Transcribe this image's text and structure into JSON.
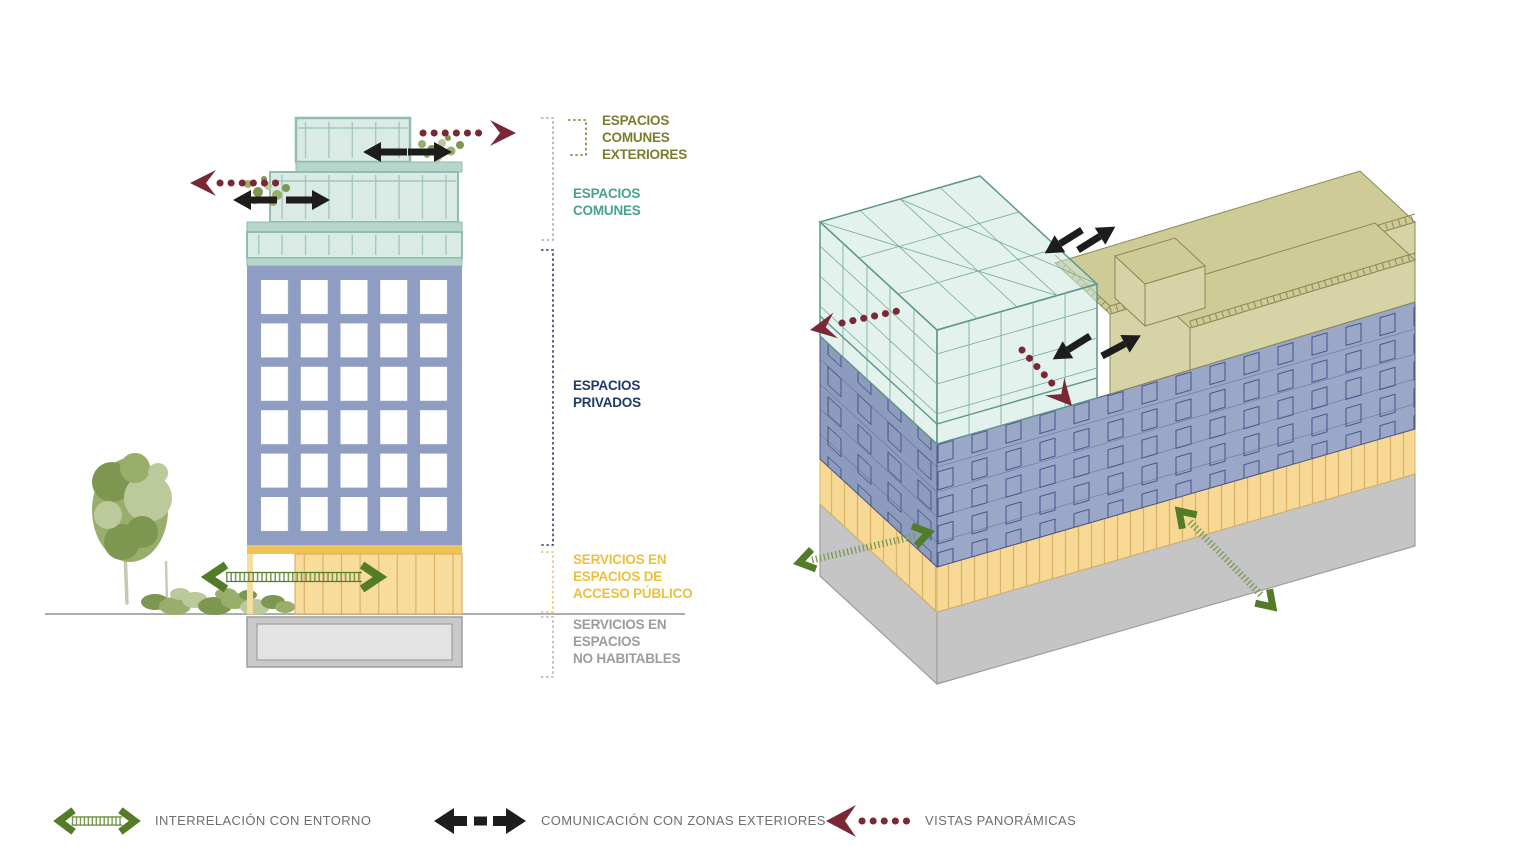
{
  "section_labels": [
    {
      "id": "comunes-exteriores",
      "lines": [
        "ESPACIOS",
        "COMUNES",
        "EXTERIORES"
      ],
      "color": "#7c7c30"
    },
    {
      "id": "comunes",
      "lines": [
        "ESPACIOS",
        "COMUNES"
      ],
      "color": "#47a28f"
    },
    {
      "id": "privados",
      "lines": [
        "ESPACIOS",
        "PRIVADOS"
      ],
      "color": "#1e3a66"
    },
    {
      "id": "servicios-publico",
      "lines": [
        "SERVICIOS EN",
        "ESPACIOS DE",
        "ACCESO PÚBLICO"
      ],
      "color": "#ecbf3e"
    },
    {
      "id": "servicios-no-habitables",
      "lines": [
        "SERVICIOS EN",
        "ESPACIOS",
        "NO HABITABLES"
      ],
      "color": "#9c9c9b"
    }
  ],
  "legend": {
    "items": [
      {
        "icon": "interrelation-arrow-icon",
        "label": "INTERRELACIÓN CON ENTORNO"
      },
      {
        "icon": "communication-arrow-icon",
        "label": "COMUNICACIÓN CON ZONAS EXTERIORES"
      },
      {
        "icon": "panoramic-views-arrow-icon",
        "label": "VISTAS PANORÁMICAS"
      }
    ]
  },
  "colors": {
    "teal_glass": "#d9ebe4",
    "teal_slab": "#b7d5cc",
    "teal_frame": "#8fbdb1",
    "teal_mullion": "#a3c7bd",
    "teal_dark": "#5f968a",
    "teal_grid": "#74a89b",
    "axon_teal": "#cde7df",
    "blue_body": "#8e9dc1",
    "axon_blue": "#9aa7c7",
    "axon_blue_left": "#8d9cbd",
    "blue_line": "#46548a",
    "window_white": "#ffffff",
    "yellow_band": "#f8dc9c",
    "yellow_dark": "#efc257",
    "yellow_stripe": "#d8b166",
    "axon_yellow": "#f7d995",
    "plinth_gray": "#c9c9c9",
    "plinth_inner": "#e3e3e3",
    "plinth_line": "#9e9e9e",
    "axon_gray": "#c5c5c5",
    "olive_roof": "#d6d3a6",
    "olive_deck": "#cfcb97",
    "olive_line": "#8a8857",
    "green_arrow": "#527c28",
    "green_mid": "#7d9c58",
    "maroon_arrow": "#7b2836",
    "black_arrow": "#1d1d1b",
    "ground_line": "#adadad",
    "legend_text": "#6f6d6e",
    "bracket_teal": "#9db0ab",
    "bracket_olive": "#7c7c30",
    "bracket_navy": "#2c3e66",
    "bracket_yellow": "#e8c660",
    "bracket_gray": "#b5b5b5",
    "foliage_dark": "#7d9751",
    "foliage_mid": "#9aae6b",
    "foliage_light": "#bcc99b",
    "trunk": "#c2cbb0"
  }
}
